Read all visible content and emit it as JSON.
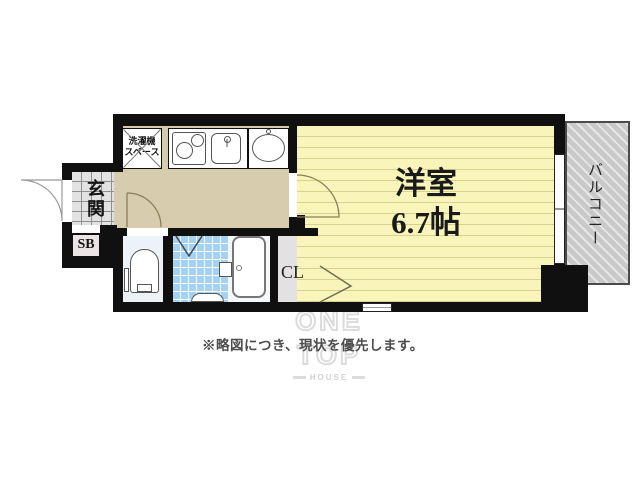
{
  "plan": {
    "rooms": {
      "main_room": {
        "name": "洋室",
        "size": "6.7帖"
      },
      "balcony_label": "バルコニー",
      "entrance_label": "玄関",
      "shoe_box_label": "SB",
      "closet_label": "CL",
      "washer_space_label": "洗濯機\nスペース"
    },
    "colors": {
      "wall": "#101010",
      "hall_floor": "#D8CCAE",
      "main_room_floor": "#F9F5BA",
      "bath_tile": "#A5D2F2",
      "toilet_floor": "#EDF2F8",
      "balcony": "#C9C9C9",
      "closet": "#E3E1E1",
      "genkan_tile": "#E2E2E2"
    }
  },
  "disclaimer": "※略図につき、現状を優先します。",
  "logo": {
    "line1": "ONE",
    "line2": "TOP",
    "line3": "HOUSE"
  }
}
